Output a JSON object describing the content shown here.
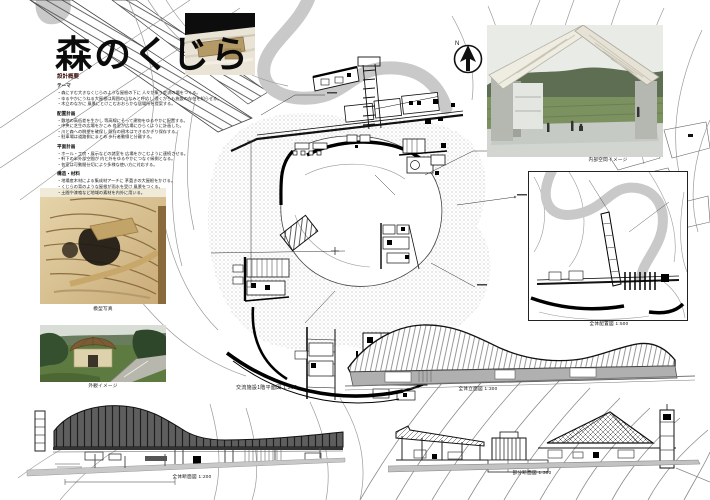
{
  "title": "森のくじら",
  "subtitle": "設計概要",
  "concept": {
    "sections": [
      {
        "heading": "テーマ",
        "body": "・森にすむ大きなくじらのような屋根の下に 人々が集う交流の場をつくる。\n・ゆるやかにうねる大屋根は周囲の山なみと呼応し 遠くからも施設の存在を知らせる。\n・木立のなかに 風景にとけこむおおらかな居場所を提案する。"
      },
      {
        "heading": "配置計画",
        "body": "・敷地の高低差を生かし 等高線にそって建物をゆるやかに配置する。\n・中央に芝生の広場をかこみ 各室が広場にひらくように計画した。\n・川と森への眺望を確保し 既存の樹木はできるかぎり保存する。\n・駐車場は道路側にまとめ 歩行者動線と分離する。"
      },
      {
        "heading": "平面計画",
        "body": "・ホール・工房・展示などの諸室を 広場をかこむように連続させる。\n・軒下の半外部空間が 内と外をゆるやかにつなぐ縁側となる。\n・各室は可動間仕切により多様な使い方に対応する。"
      },
      {
        "heading": "構造・材料",
        "body": "・地場産木材による集成材アーチに 茅葺きの大屋根をかける。\n・くじらの背のような屋根が雨水を受け 風景をつくる。\n・土間や漆喰など地域の素材を内外に用いる。"
      }
    ]
  },
  "captions": {
    "render": "内部空間イメージ",
    "site_model": "模型写真",
    "exterior_photo": "外観イメージ",
    "main_plan": "交流施設1階平面図 1:200",
    "overall_plan": "全体配置図 1:500",
    "left_section": "全体断面図 1:200",
    "mid_elevation": "全体立面図 1:300",
    "right_section": "部分断面図 1:300"
  },
  "compass": {
    "label": "N"
  },
  "colors": {
    "river": "#c9c9c9",
    "roof_dark": "#606060",
    "ground": "#c8c8c8",
    "model_tan": "#d8c49a"
  }
}
